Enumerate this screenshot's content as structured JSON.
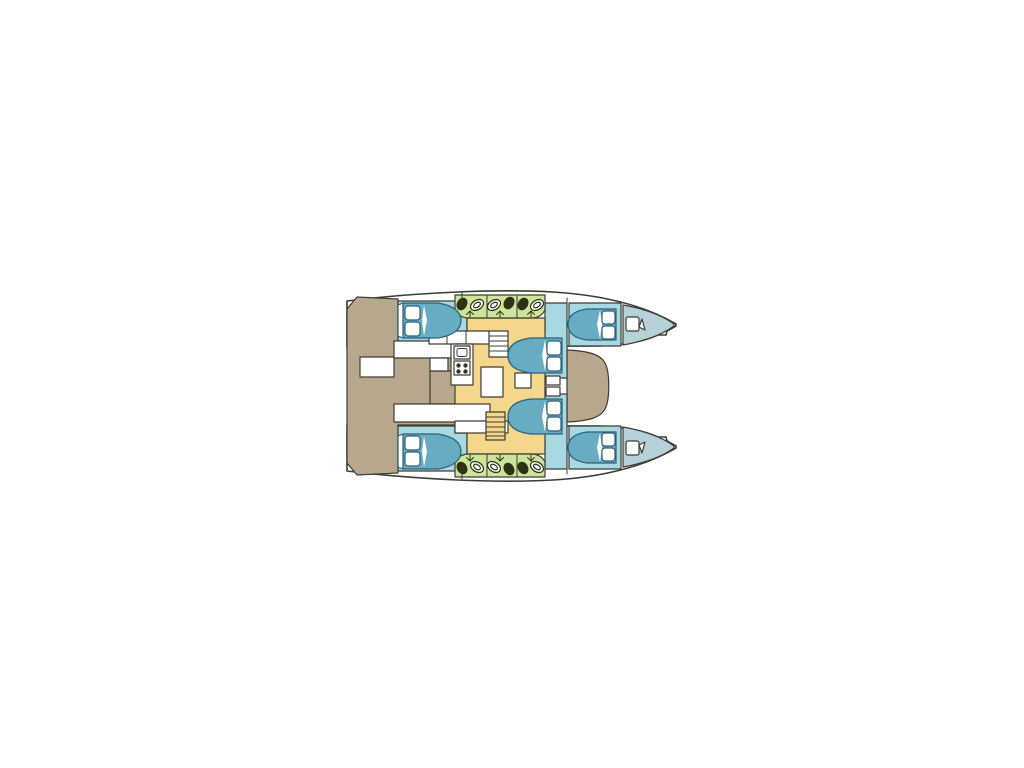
{
  "diagram": {
    "kind": "catamaran-yacht-floor-plan",
    "view": "top-down deck layout, bow pointing right"
  },
  "colors": {
    "page": "#ffffff",
    "outline": "#3e3c35",
    "deck": "#b7a78d",
    "salon": "#f5d78b",
    "cabin": "#a8d8e2",
    "bed": "#66adc4",
    "bed_outline": "#2e6077",
    "bow": "#b7d1d9",
    "head": "#cde59a",
    "fixture": "#2f3212",
    "white": "#ffffff"
  },
  "icons": {
    "toilet": "toilet-icon",
    "sink": "sink-oval-icon",
    "galley_sink": "galley-sink-icon",
    "stove": "stove-burners-icon",
    "stairs": "companionway-stairs-icon",
    "shower_arrow": "shower-arrow-icon",
    "bow_berth": "bow-berth-icon",
    "bow_flag": "bow-flag-icon"
  },
  "regions": [
    "aft-cockpit",
    "cockpit-bench",
    "cockpit-table",
    "salon",
    "galley-counter",
    "salon-table",
    "foredeck",
    "port-hull",
    "starboard-hull",
    "port-aft-cabin",
    "port-mid-cabin",
    "port-fwd-cabin",
    "port-head",
    "stbd-aft-cabin",
    "stbd-mid-cabin",
    "stbd-fwd-cabin",
    "stbd-head",
    "port-bow-locker",
    "stbd-bow-locker"
  ]
}
